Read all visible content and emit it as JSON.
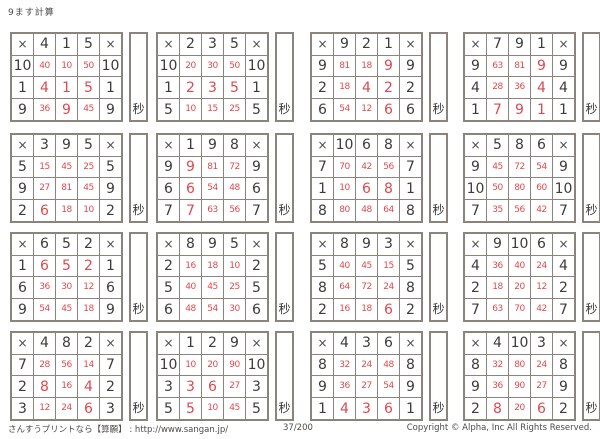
{
  "title": "9ます計算",
  "op": "×",
  "seconds_label": "秒",
  "colors": {
    "ink": "#3e3c39",
    "answer_red": "#dd4a4e",
    "grid_border": "#8b847c",
    "paper": "#ffffff"
  },
  "grids": [
    {
      "top": [
        "4",
        "1",
        "5"
      ],
      "rows": [
        [
          "10",
          "40",
          "10",
          "50"
        ],
        [
          "1",
          "4",
          "1",
          "5"
        ],
        [
          "9",
          "36",
          "9",
          "45"
        ]
      ]
    },
    {
      "top": [
        "2",
        "3",
        "5"
      ],
      "rows": [
        [
          "10",
          "20",
          "30",
          "50"
        ],
        [
          "1",
          "2",
          "3",
          "5"
        ],
        [
          "5",
          "10",
          "15",
          "25"
        ]
      ]
    },
    {
      "top": [
        "9",
        "2",
        "1"
      ],
      "rows": [
        [
          "9",
          "81",
          "18",
          "9"
        ],
        [
          "2",
          "18",
          "4",
          "2"
        ],
        [
          "6",
          "54",
          "12",
          "6"
        ]
      ]
    },
    {
      "top": [
        "7",
        "9",
        "1"
      ],
      "rows": [
        [
          "9",
          "63",
          "81",
          "9"
        ],
        [
          "4",
          "28",
          "36",
          "4"
        ],
        [
          "1",
          "7",
          "9",
          "1"
        ]
      ]
    },
    {
      "top": [
        "3",
        "9",
        "5"
      ],
      "rows": [
        [
          "5",
          "15",
          "45",
          "25"
        ],
        [
          "9",
          "27",
          "81",
          "45"
        ],
        [
          "2",
          "6",
          "18",
          "10"
        ]
      ]
    },
    {
      "top": [
        "1",
        "9",
        "8"
      ],
      "rows": [
        [
          "9",
          "9",
          "81",
          "72"
        ],
        [
          "6",
          "6",
          "54",
          "48"
        ],
        [
          "7",
          "7",
          "63",
          "56"
        ]
      ]
    },
    {
      "top": [
        "10",
        "6",
        "8"
      ],
      "rows": [
        [
          "7",
          "70",
          "42",
          "56"
        ],
        [
          "1",
          "10",
          "6",
          "8"
        ],
        [
          "8",
          "80",
          "48",
          "64"
        ]
      ]
    },
    {
      "top": [
        "5",
        "8",
        "6"
      ],
      "rows": [
        [
          "9",
          "45",
          "72",
          "54"
        ],
        [
          "10",
          "50",
          "80",
          "60"
        ],
        [
          "7",
          "35",
          "56",
          "42"
        ]
      ]
    },
    {
      "top": [
        "6",
        "5",
        "2"
      ],
      "rows": [
        [
          "1",
          "6",
          "5",
          "2"
        ],
        [
          "6",
          "36",
          "30",
          "12"
        ],
        [
          "9",
          "54",
          "45",
          "18"
        ]
      ]
    },
    {
      "top": [
        "8",
        "9",
        "5"
      ],
      "rows": [
        [
          "2",
          "16",
          "18",
          "10"
        ],
        [
          "5",
          "40",
          "45",
          "25"
        ],
        [
          "6",
          "48",
          "54",
          "30"
        ]
      ]
    },
    {
      "top": [
        "8",
        "9",
        "3"
      ],
      "rows": [
        [
          "5",
          "40",
          "45",
          "15"
        ],
        [
          "8",
          "64",
          "72",
          "24"
        ],
        [
          "2",
          "16",
          "18",
          "6"
        ]
      ]
    },
    {
      "top": [
        "9",
        "10",
        "6"
      ],
      "rows": [
        [
          "4",
          "36",
          "40",
          "24"
        ],
        [
          "2",
          "18",
          "20",
          "12"
        ],
        [
          "7",
          "63",
          "70",
          "42"
        ]
      ]
    },
    {
      "top": [
        "4",
        "8",
        "2"
      ],
      "rows": [
        [
          "7",
          "28",
          "56",
          "14"
        ],
        [
          "2",
          "8",
          "16",
          "4"
        ],
        [
          "3",
          "12",
          "24",
          "6"
        ]
      ]
    },
    {
      "top": [
        "1",
        "2",
        "9"
      ],
      "rows": [
        [
          "10",
          "10",
          "20",
          "90"
        ],
        [
          "3",
          "3",
          "6",
          "27"
        ],
        [
          "5",
          "5",
          "10",
          "45"
        ]
      ]
    },
    {
      "top": [
        "4",
        "3",
        "6"
      ],
      "rows": [
        [
          "8",
          "32",
          "24",
          "48"
        ],
        [
          "9",
          "36",
          "27",
          "54"
        ],
        [
          "1",
          "4",
          "3",
          "6"
        ]
      ]
    },
    {
      "top": [
        "4",
        "10",
        "3"
      ],
      "rows": [
        [
          "8",
          "32",
          "80",
          "24"
        ],
        [
          "9",
          "36",
          "90",
          "27"
        ],
        [
          "2",
          "8",
          "20",
          "6"
        ]
      ]
    }
  ],
  "footer": {
    "site": "さんすうプリントなら【算願】 : http://www.sangan.jp/",
    "page": "37/200",
    "copyright": "Copyright © Alpha, Inc All Rights Reserved."
  }
}
